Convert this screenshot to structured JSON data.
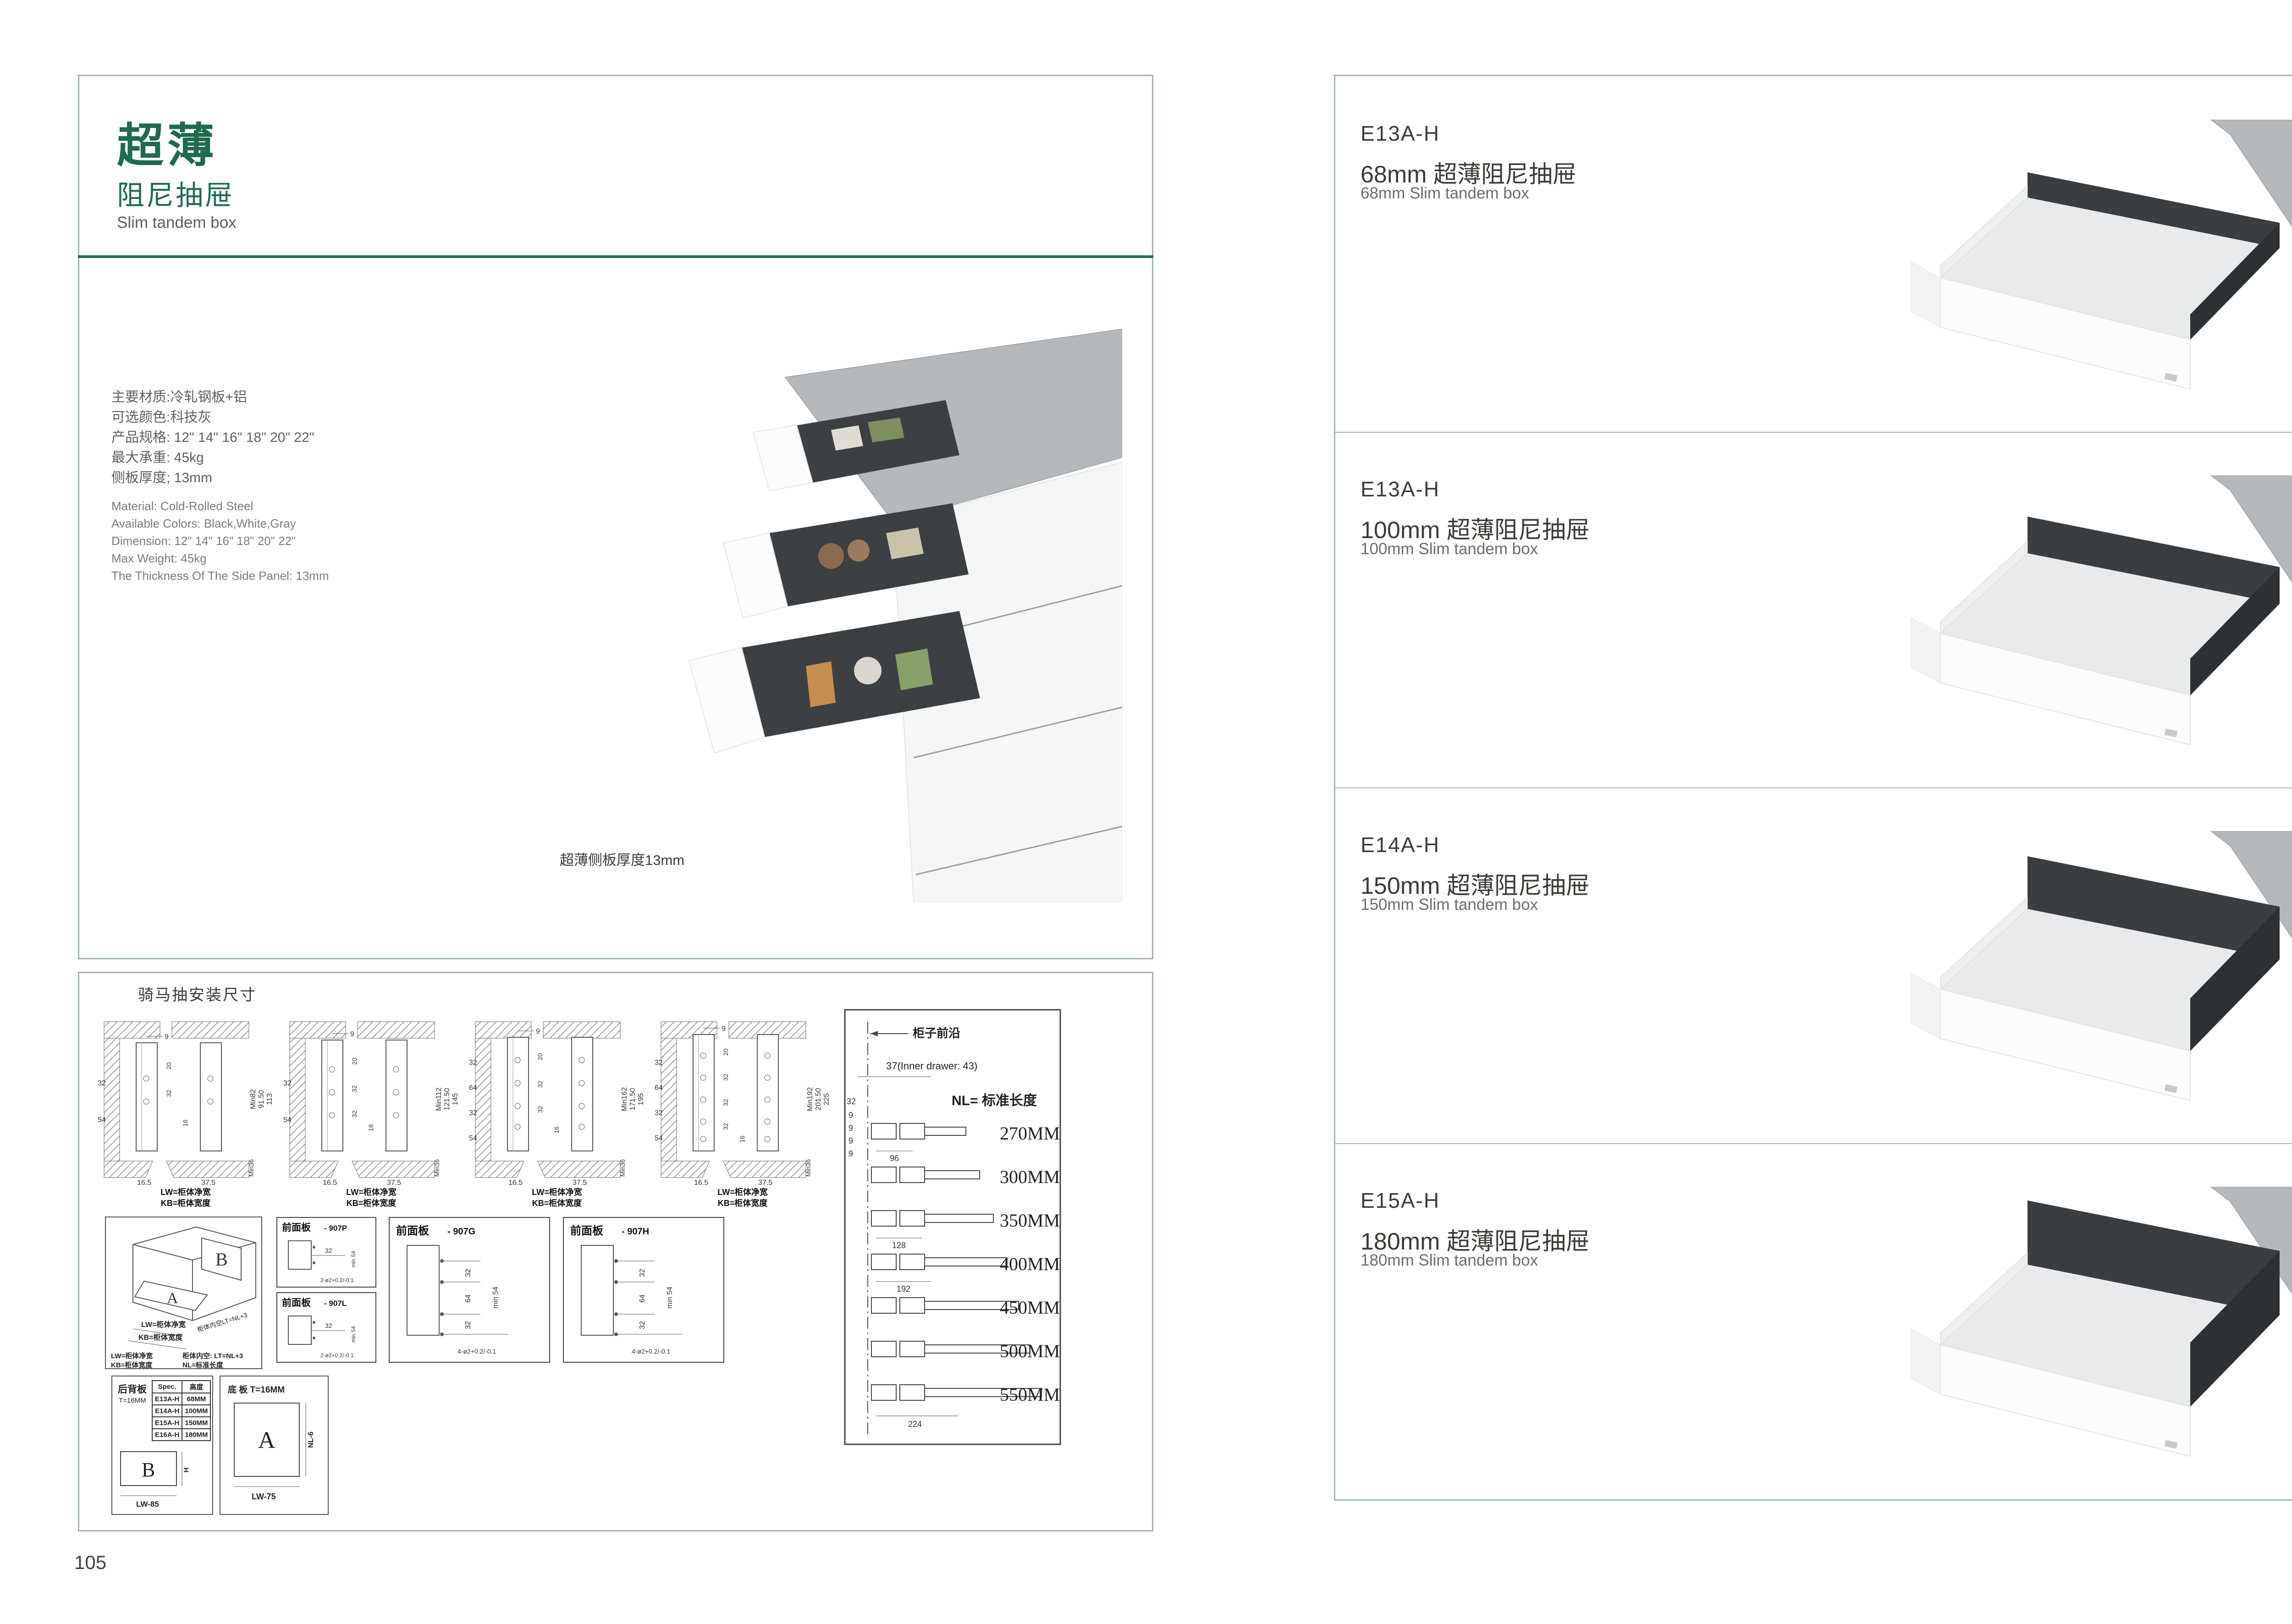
{
  "colors": {
    "accent_green": "#1e6b4e",
    "border_teal": "#9fb7ab",
    "divider_green": "#2c6a4f",
    "drawer_dark": "#3a3e41",
    "counter_gray": "#b6b9bb"
  },
  "left": {
    "page_number": "105",
    "header": {
      "title_cn": "超薄",
      "subtitle_cn": "阻尼抽屉",
      "subtitle_en": "Slim tandem box"
    },
    "specs_cn": [
      "主要材质:冷轧钢板+铝",
      "可选颜色:科技灰",
      "产品规格: 12\" 14\" 16\" 18\" 20\" 22\"",
      "最大承重: 45kg",
      "侧板厚度; 13mm"
    ],
    "specs_en": [
      "Material: Cold-Rolled Steel",
      "Available Colors: Black,White,Gray",
      "Dimension: 12\" 14\" 16\" 18\" 20\" 22\"",
      "Max Weight: 45kg",
      "The Thickness Of The Side Panel: 13mm"
    ],
    "image_caption": "超薄侧板厚度13mm",
    "drawings": {
      "title": "骑马抽安装尺寸",
      "cross_sections": [
        {
          "top": "9",
          "inner": [
            "20",
            "32"
          ],
          "mid": "16",
          "left": [
            "32",
            "54"
          ],
          "right": [
            "Min82",
            "91.50",
            "113"
          ],
          "bottom": [
            "16.5",
            "37.5"
          ],
          "min36": "Min36",
          "lw": "LW=柜体净宽",
          "kb": "KB=柜体宽度"
        },
        {
          "top": "9",
          "inner": [
            "20",
            "32",
            "32"
          ],
          "mid": "16",
          "left": [
            "32",
            "54"
          ],
          "right": [
            "Min112",
            "121.50",
            "145"
          ],
          "bottom": [
            "16.5",
            "37.5"
          ],
          "min36": "Min36",
          "lw": "LW=柜体净宽",
          "kb": "KB=柜体宽度"
        },
        {
          "top": "9",
          "inner": [
            "20",
            "32",
            "32"
          ],
          "mid": "16",
          "left": [
            "32",
            "64",
            "32",
            "54"
          ],
          "right": [
            "Min162",
            "171.50",
            "195"
          ],
          "bottom": [
            "16.5",
            "37.5"
          ],
          "min36": "Min36",
          "lw": "LW=柜体净宽",
          "kb": "KB=柜体宽度"
        },
        {
          "top": "9",
          "inner": [
            "20",
            "32",
            "32",
            "32",
            "32"
          ],
          "mid": "16",
          "left": [
            "32",
            "64",
            "32",
            "54"
          ],
          "right": [
            "Min192",
            "201.50",
            "225"
          ],
          "bottom": [
            "16.5",
            "37.5"
          ],
          "min36": "Min36",
          "lw": "LW=柜体净宽",
          "kb": "KB=柜体宽度"
        }
      ],
      "iso": {
        "a": "A",
        "b": "B",
        "lw": "LW=柜体净宽",
        "kb": "KB=柜体宽度",
        "lt": "柜体内空LT=NL+3",
        "legend_lw": "LW=柜体净宽",
        "legend_lt": "柜体内空: LT=NL+3",
        "legend_kb": "KB=柜体宽度",
        "legend_nl": "NL=标准长度"
      },
      "front_panels": [
        {
          "name": "前面板",
          "code": "- 907P",
          "dims": [
            "32"
          ],
          "min": "min 54",
          "holes": "2-ø2+0.2/-0.1"
        },
        {
          "name": "前面板",
          "code": "- 907L",
          "dims": [
            "32"
          ],
          "min": "min 54",
          "holes": "2-ø2+0.2/-0.1"
        },
        {
          "name": "前面板",
          "code": "- 907G",
          "dims": [
            "32",
            "64",
            "32"
          ],
          "min": "min 54",
          "holes": "4-ø2+0.2/-0.1"
        },
        {
          "name": "前面板",
          "code": "- 907H",
          "dims": [
            "32",
            "64",
            "32"
          ],
          "min": "min 54",
          "holes": "4-ø2+0.2/-0.1"
        }
      ],
      "back_panel": {
        "title": "后背板",
        "thickness": "T=16MM",
        "table": {
          "col1": "Spec.",
          "col2": "高度",
          "rows": [
            [
              "E13A-H",
              "68MM"
            ],
            [
              "E14A-H",
              "100MM"
            ],
            [
              "E15A-H",
              "150MM"
            ],
            [
              "E16A-H",
              "180MM"
            ]
          ]
        },
        "shape": "B",
        "h": "H",
        "width": "LW-85"
      },
      "bottom_panel": {
        "title": "底 板 T=16MM",
        "shape": "A",
        "nl": "NL-6",
        "width": "LW-75"
      },
      "nl_table": {
        "front_edge": "柜子前沿",
        "inner_drawer": "37(Inner drawer: 43)",
        "left_dims": [
          "32",
          "9",
          "9",
          "9",
          "9"
        ],
        "nl": "NL= 标准长度",
        "lengths": [
          "270MM",
          "300MM",
          "350MM",
          "400MM",
          "450MM",
          "500MM",
          "550MM"
        ],
        "spacings": {
          "row1": "96",
          "row3": "128",
          "row4": "192",
          "row7": "224"
        }
      }
    }
  },
  "right": {
    "page_number": "106",
    "sections": [
      {
        "code": "E13A-H",
        "subtitle_cn": "68mm 超薄阻尼抽屉",
        "subtitle_en": "68mm Slim tandem box"
      },
      {
        "code": "E13A-H",
        "subtitle_cn": "100mm 超薄阻尼抽屉",
        "subtitle_en": "100mm Slim tandem box"
      },
      {
        "code": "E14A-H",
        "subtitle_cn": "150mm 超薄阻尼抽屉",
        "subtitle_en": "150mm Slim tandem box"
      },
      {
        "code": "E15A-H",
        "subtitle_cn": "180mm 超薄阻尼抽屉",
        "subtitle_en": "180mm Slim tandem box"
      }
    ]
  }
}
